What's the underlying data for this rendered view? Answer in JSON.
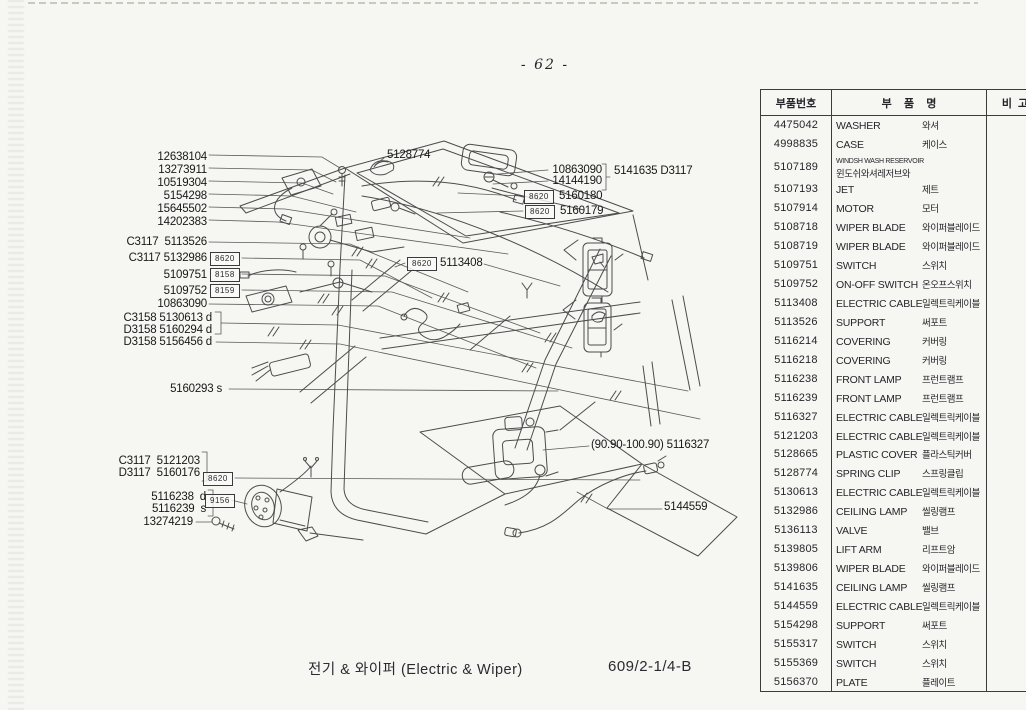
{
  "page": {
    "number": "- 62 -"
  },
  "footer": {
    "title": "전기 & 와이퍼 (Electric & Wiper)",
    "doc_code": "609/2-1/4-B"
  },
  "table": {
    "headers": {
      "part_no": "부품번호",
      "part_name": "부    품    명",
      "remark": "비  고"
    },
    "rows": [
      {
        "no": "4475042",
        "en": "WASHER",
        "ko": "와셔"
      },
      {
        "no": "4998835",
        "en": "CASE",
        "ko": "케이스"
      },
      {
        "no": "5107189",
        "en": "WINDSH WASH RESERVOIR",
        "ko": "윈도쉬와셔레저브와"
      },
      {
        "no": "5107193",
        "en": "JET",
        "ko": "제트"
      },
      {
        "no": "5107914",
        "en": "MOTOR",
        "ko": "모터"
      },
      {
        "no": "5108718",
        "en": "WIPER BLADE",
        "ko": "와이퍼블레이드"
      },
      {
        "no": "5108719",
        "en": "WIPER BLADE",
        "ko": "와이퍼블레이드"
      },
      {
        "no": "5109751",
        "en": "SWITCH",
        "ko": "스위치"
      },
      {
        "no": "5109752",
        "en": "ON-OFF SWITCH",
        "ko": "온오프스위치"
      },
      {
        "no": "5113408",
        "en": "ELECTRIC CABLE",
        "ko": "일렉트릭케이블"
      },
      {
        "no": "5113526",
        "en": "SUPPORT",
        "ko": "써포트"
      },
      {
        "no": "5116214",
        "en": "COVERING",
        "ko": "커버링"
      },
      {
        "no": "5116218",
        "en": "COVERING",
        "ko": "커버링"
      },
      {
        "no": "5116238",
        "en": "FRONT LAMP",
        "ko": "프런트램프"
      },
      {
        "no": "5116239",
        "en": "FRONT LAMP",
        "ko": "프런트램프"
      },
      {
        "no": "5116327",
        "en": "ELECTRIC CABLE",
        "ko": "일렉트릭케이블"
      },
      {
        "no": "5121203",
        "en": "ELECTRIC CABLE",
        "ko": "일렉트릭케이블"
      },
      {
        "no": "5128665",
        "en": "PLASTIC COVER",
        "ko": "플라스틱커버"
      },
      {
        "no": "5128774",
        "en": "SPRING CLIP",
        "ko": "스프링클립"
      },
      {
        "no": "5130613",
        "en": "ELECTRIC CABLE",
        "ko": "일렉트릭케이블"
      },
      {
        "no": "5132986",
        "en": "CEILING LAMP",
        "ko": "씰링램프"
      },
      {
        "no": "5136113",
        "en": "VALVE",
        "ko": "밸브"
      },
      {
        "no": "5139805",
        "en": "LIFT ARM",
        "ko": "리프트암"
      },
      {
        "no": "5139806",
        "en": "WIPER BLADE",
        "ko": "와이퍼블레이드"
      },
      {
        "no": "5141635",
        "en": "CEILING LAMP",
        "ko": "씰링램프"
      },
      {
        "no": "5144559",
        "en": "ELECTRIC CABLE",
        "ko": "일렉트릭케이블"
      },
      {
        "no": "5154298",
        "en": "SUPPORT",
        "ko": "써포트"
      },
      {
        "no": "5155317",
        "en": "SWITCH",
        "ko": "스위치"
      },
      {
        "no": "5155369",
        "en": "SWITCH",
        "ko": "스위치"
      },
      {
        "no": "5156370",
        "en": "PLATE",
        "ko": "플레이트"
      }
    ]
  },
  "callouts": {
    "k12638104": {
      "text": "12638104"
    },
    "k13273911": {
      "text": "13273911"
    },
    "k10519304": {
      "text": "10519304"
    },
    "k5154298": {
      "text": "5154298"
    },
    "k15645502": {
      "text": "15645502"
    },
    "k14202383": {
      "text": "14202383"
    },
    "k5113526": {
      "text": "C3117  5113526"
    },
    "k5132986": {
      "text": "C3117 5132986",
      "box": "8620"
    },
    "k5109751": {
      "text": "5109751",
      "box": "8158"
    },
    "k5109752": {
      "text": "5109752",
      "box": "8159"
    },
    "k10863090L": {
      "text": "10863090"
    },
    "k5130613": {
      "text": "C3158 5130613 d"
    },
    "k5160294": {
      "text": "D3158 5160294 d"
    },
    "k5156456": {
      "text": "D3158 5156456 d"
    },
    "k5160293": {
      "text": "5160293 s"
    },
    "k5121203": {
      "text": "C3117  5121203"
    },
    "k5160176": {
      "text": "D3117  5160176",
      "box": "8620"
    },
    "k5116238": {
      "text": "5116238  d"
    },
    "k5116239": {
      "text": "5116239  s",
      "box": "9156"
    },
    "k13274219": {
      "text": "13274219"
    },
    "k5128774": {
      "text": "5128774"
    },
    "k10863090R": {
      "text": "10863090"
    },
    "k14144190": {
      "text": "14144190"
    },
    "k5141635": {
      "text": "5141635 D3117"
    },
    "k5160180": {
      "text": "5160180",
      "box": "8620"
    },
    "k5160179": {
      "text": "5160179",
      "box": "8620"
    },
    "k5113408": {
      "text": "5113408",
      "box": "8620"
    },
    "k5116327": {
      "text": "(90.90-100.90) 5116327"
    },
    "k5144559": {
      "text": "5144559"
    }
  }
}
